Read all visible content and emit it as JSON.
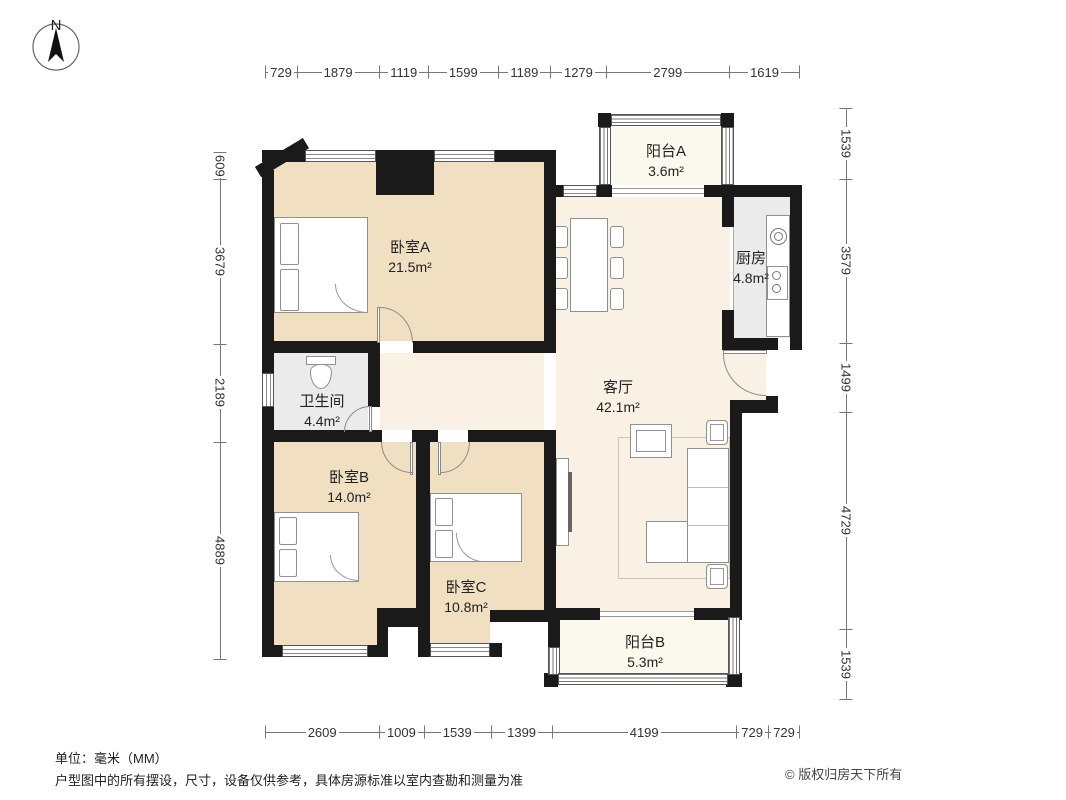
{
  "compass": {
    "label": "N"
  },
  "dimensions": {
    "top": [
      729,
      1879,
      1119,
      1599,
      1189,
      1279,
      2799,
      1619
    ],
    "bottom": [
      2609,
      1009,
      1539,
      1399,
      4199,
      729,
      729
    ],
    "left": [
      609,
      3679,
      2189,
      4889
    ],
    "right": [
      1539,
      3579,
      1499,
      4729,
      1539
    ]
  },
  "rooms": [
    {
      "id": "bedroom-a",
      "name": "卧室A",
      "area": "21.5m²"
    },
    {
      "id": "balcony-a",
      "name": "阳台A",
      "area": "3.6m²"
    },
    {
      "id": "kitchen",
      "name": "厨房",
      "area": "4.8m²"
    },
    {
      "id": "living",
      "name": "客厅",
      "area": "42.1m²"
    },
    {
      "id": "bathroom",
      "name": "卫生间",
      "area": "4.4m²"
    },
    {
      "id": "bedroom-b",
      "name": "卧室B",
      "area": "14.0m²"
    },
    {
      "id": "bedroom-c",
      "name": "卧室C",
      "area": "10.8m²"
    },
    {
      "id": "balcony-b",
      "name": "阳台B",
      "area": "5.3m²"
    }
  ],
  "footer": {
    "unit_note": "单位：毫米（MM）",
    "disclaimer": "户型图中的所有摆设，尺寸，设备仅供参考，具体房源标准以室内查勘和测量为准",
    "copyright": "© 版权归房天下所有"
  },
  "colors": {
    "wall": "#1a1a1a",
    "bedroom_floor": "#f0e0c1",
    "living_floor": "#f9f1e3",
    "balcony_floor": "#fbf8ed",
    "service_floor": "#ebebeb",
    "dimension": "#777777",
    "text": "#222222"
  }
}
